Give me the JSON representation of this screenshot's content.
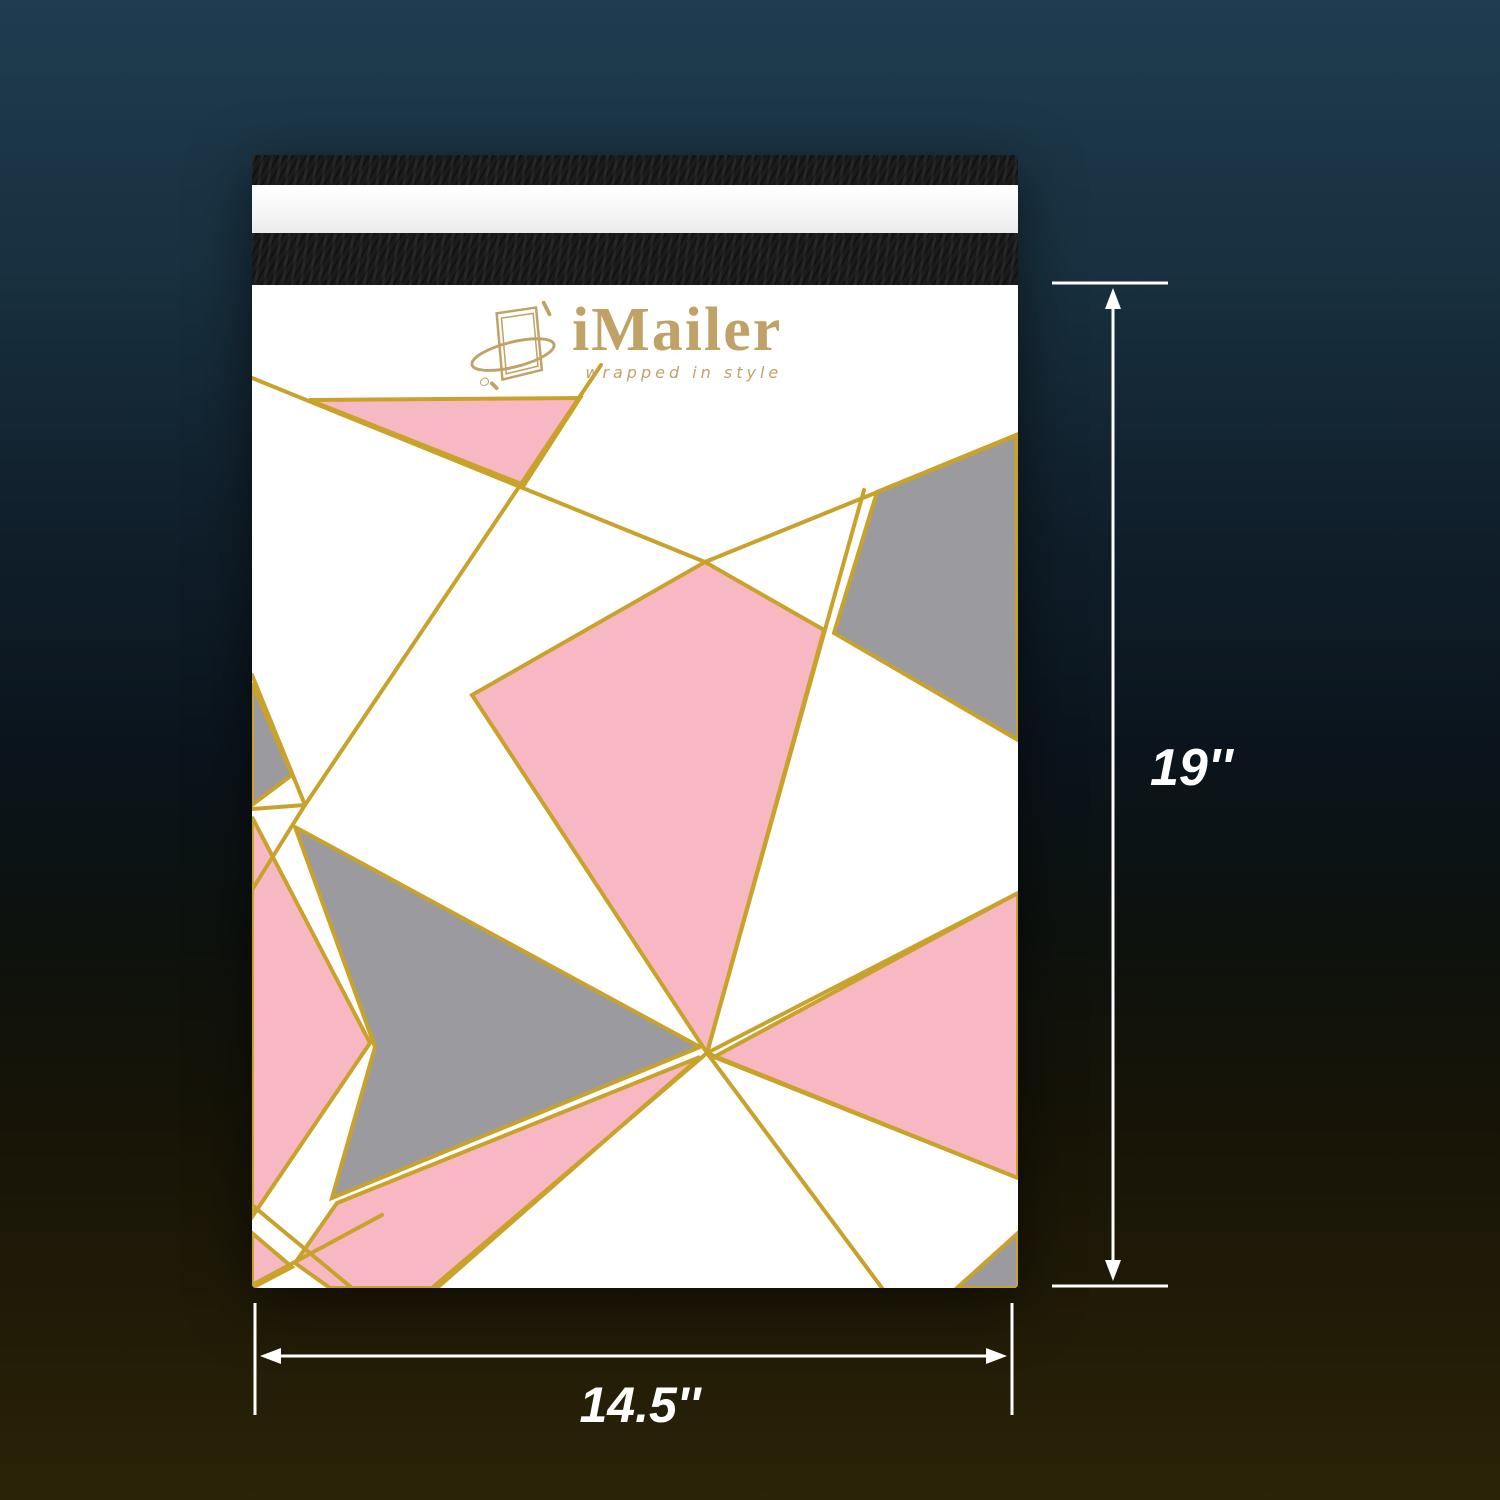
{
  "scene": {
    "brand": "iMailer",
    "tagline": "wrapped in style",
    "height_label": "19''",
    "width_label": "14.5''"
  },
  "colors": {
    "background_top": "#1F3C50",
    "background_bottom": "#2B2307",
    "mailer_white": "#FFFFFF",
    "liner_white": "#F3F3F3",
    "flap_black": "#1B1B1B",
    "pink": "#F8B8C3",
    "gray": "#9B9B9F",
    "gold": "#C9A22B",
    "logo_gold": "#C0A266",
    "annotation": "#FFFFFF"
  }
}
